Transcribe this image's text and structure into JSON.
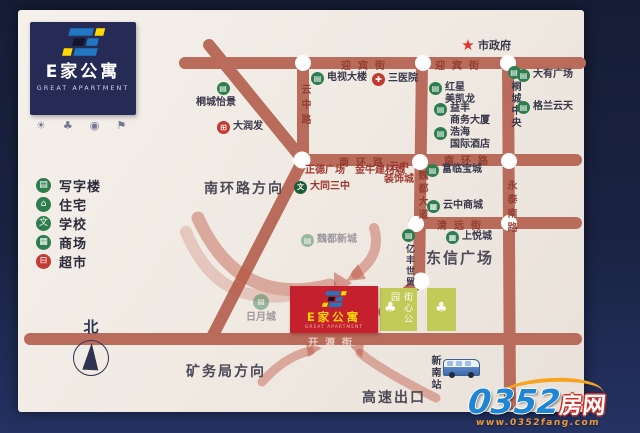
{
  "brand": {
    "logo_cn": "E家公寓",
    "logo_en": "GREAT APARTMENT"
  },
  "colors": {
    "accent_red": "#c4202e",
    "road": "#b96c5c",
    "poi_green": "#2e7d4e",
    "poi_red": "#c23a33",
    "park_green": "#c2ca58",
    "brand_navy": "#262b55",
    "logo_blue": "#2277c2",
    "logo_yellow": "#ffd900",
    "watermark_blue": "#1e86d4"
  },
  "mini_icons": {
    "glyphs": [
      "☀",
      "♣",
      "◉",
      "⚑"
    ]
  },
  "legend": [
    {
      "label": "写字楼",
      "glyph": "▤"
    },
    {
      "label": "住宅",
      "glyph": "⌂"
    },
    {
      "label": "学校",
      "glyph": "文"
    },
    {
      "label": "商场",
      "glyph": "▦"
    },
    {
      "label": "超市",
      "glyph": "⊟"
    }
  ],
  "compass": {
    "label": "北"
  },
  "roads": {
    "yingbin_1": "迎宾街",
    "yingbin_2": "迎宾街",
    "yunzhong": "云中路",
    "nanhuan_1": "南环路",
    "nanhuan_2": "南环路",
    "weidu": "魏都大道",
    "qingyuan": "清远街",
    "yongtai": "永泰南路",
    "kaiyuan": "开源街"
  },
  "directions": {
    "nanhuan": "南环路方向",
    "kuangwuju": "矿务局方向",
    "gaosu": "高速出口"
  },
  "pois": [
    {
      "label": "市政府",
      "glyph": "★"
    },
    {
      "label": "电视大楼",
      "glyph": "▤"
    },
    {
      "label": "三医院",
      "glyph": "✚"
    },
    {
      "label": "桐城怡景",
      "glyph": "▤"
    },
    {
      "label": "大润发",
      "glyph": "⊞"
    },
    {
      "label": "红星\n美凯龙",
      "glyph": "▤"
    },
    {
      "label": "桐城中央",
      "glyph": "▤"
    },
    {
      "label": "大有广场",
      "glyph": "▤"
    },
    {
      "label": "格兰云天",
      "glyph": "▤"
    },
    {
      "label": "益丰\n商务大厦",
      "glyph": "▤"
    },
    {
      "label": "浩海\n国际酒店",
      "glyph": "▤"
    },
    {
      "label": "正德广场　金牛建材城"
    },
    {
      "label": "大同三中",
      "glyph": "文"
    },
    {
      "label": "云中\n装饰城"
    },
    {
      "label": "魏都新城",
      "glyph": "▤"
    },
    {
      "label": "富临宝城",
      "glyph": "▤"
    },
    {
      "label": "云中商城",
      "glyph": "▦"
    },
    {
      "label": "上悦城",
      "glyph": "▦"
    },
    {
      "label": "东信广场"
    },
    {
      "label": "亿丰世贸",
      "glyph": "▤"
    },
    {
      "label": "日月城",
      "glyph": "▤"
    },
    {
      "label": "新南站"
    }
  ],
  "project": {
    "title": "E家公寓",
    "subtitle": "GREAT APARTMENT"
  },
  "park": {
    "label": "街心公园",
    "tree_glyph": "♣"
  },
  "watermark": {
    "num": "0352",
    "suffix": "房网",
    "url": "www.0352fang.com"
  }
}
